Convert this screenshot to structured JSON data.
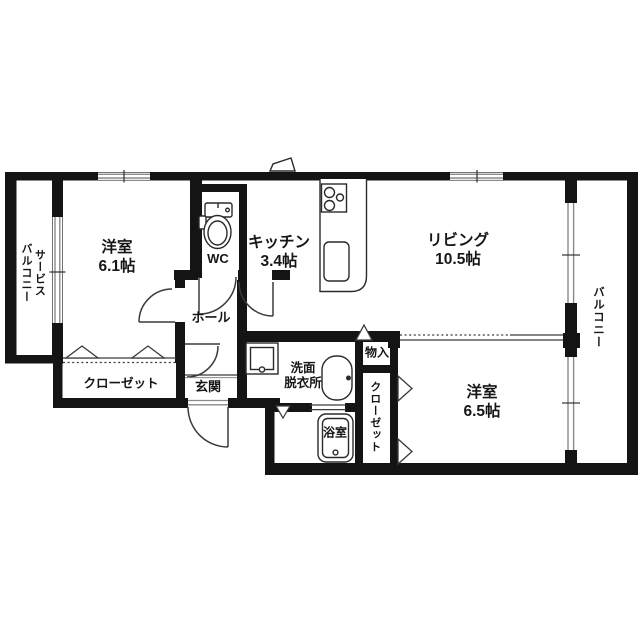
{
  "plan": {
    "type": "floorplan",
    "rooms": {
      "service_balcony": {
        "line1": "サービス",
        "line2": "バルコニー"
      },
      "bedroom1": {
        "name": "洋室",
        "size": "6.1帖"
      },
      "wc": {
        "label": "WC"
      },
      "kitchen": {
        "name": "キッチン",
        "size": "3.4帖"
      },
      "living": {
        "name": "リビング",
        "size": "10.5帖"
      },
      "balcony": {
        "label": "バルコニー"
      },
      "hall": {
        "label": "ホール"
      },
      "closet1": {
        "label": "クローゼット"
      },
      "entrance": {
        "label": "玄関"
      },
      "washroom": {
        "line1": "洗面",
        "line2": "脱衣所"
      },
      "storage": {
        "label": "物入"
      },
      "closet2": {
        "label": "クローゼット"
      },
      "bathroom": {
        "label": "浴室"
      },
      "bedroom2": {
        "name": "洋室",
        "size": "6.5帖"
      }
    },
    "colors": {
      "wall": "#141414",
      "line": "#3a3a3a",
      "window": "#8a8a8a",
      "bg": "#ffffff"
    }
  }
}
